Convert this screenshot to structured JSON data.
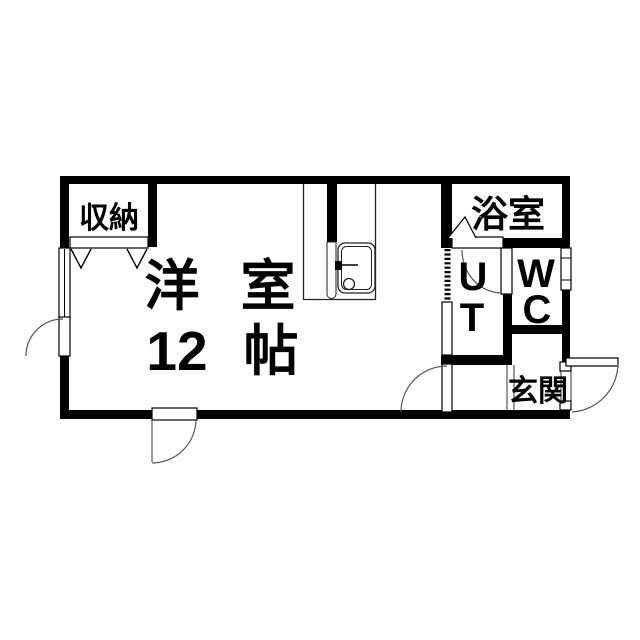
{
  "plan": {
    "colors": {
      "wall": "#000000",
      "background": "#ffffff",
      "line": "#555555"
    },
    "rooms": {
      "closet": {
        "label": "収納"
      },
      "main": {
        "line1": [
          "洋",
          "室"
        ],
        "line2": [
          "12",
          "帖"
        ]
      },
      "bathroom": {
        "label": "浴室"
      },
      "utility": {
        "chars": [
          "U",
          "T"
        ]
      },
      "toilet": {
        "chars": [
          "W",
          "C"
        ]
      },
      "entrance": {
        "label": "玄関"
      }
    }
  }
}
